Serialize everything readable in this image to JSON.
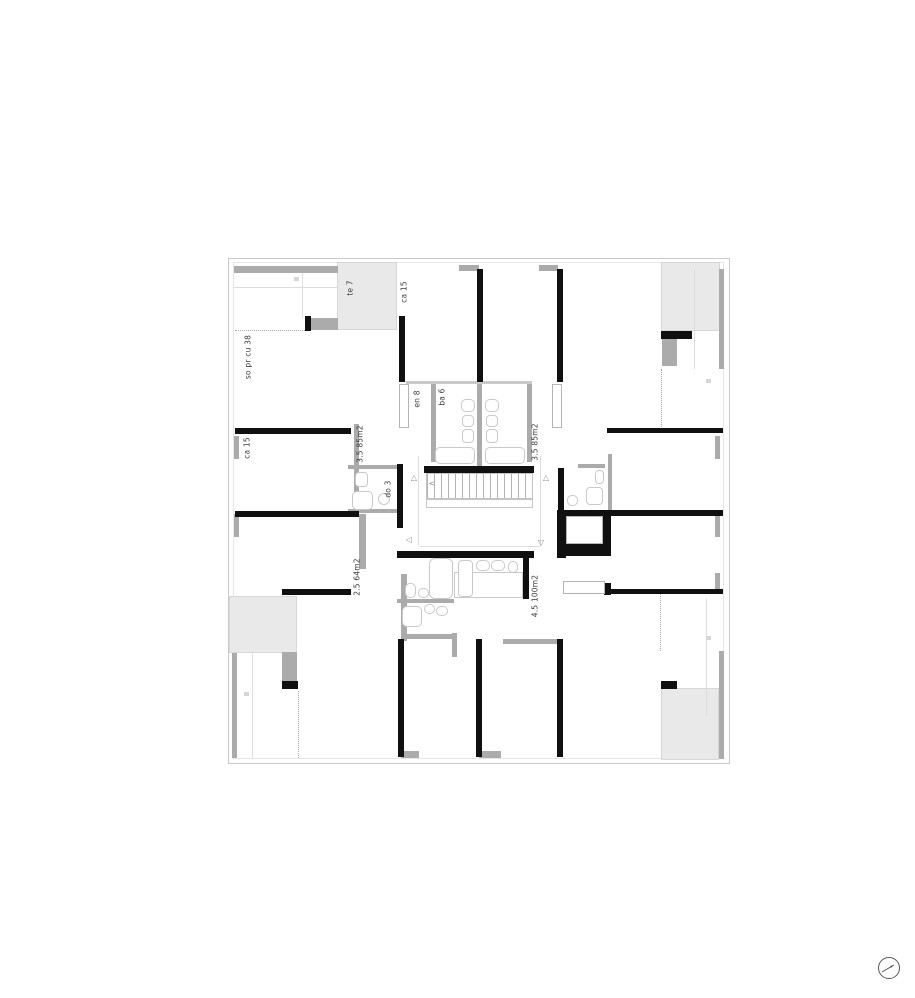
{
  "plan": {
    "name": "apartment-floor-plan",
    "labels": {
      "terrace_top": "te 7",
      "room_top": "ca 15",
      "living_top_left": "so pr cu 38",
      "room_left": "ca 15",
      "apt_35_left": "3.5 85m2",
      "bath_do": "do 3",
      "entry_en": "en 8",
      "bath_ba": "ba 6",
      "apt_35_right": "3.5 85m2",
      "apt_25": "2.5 64m2",
      "apt_45": "4.5 100m2"
    },
    "markers": {
      "stair_direction": "<",
      "door_up_left": "△",
      "door_up_right": "△",
      "door_left": "◁",
      "door_down": "▽"
    },
    "colors": {
      "wall": "#101010",
      "light_wall": "#ababab",
      "terrace_fill": "#e9e9e9",
      "fixture_line": "#c9c9c9"
    }
  },
  "compass": {
    "icon": "north-arrow"
  }
}
